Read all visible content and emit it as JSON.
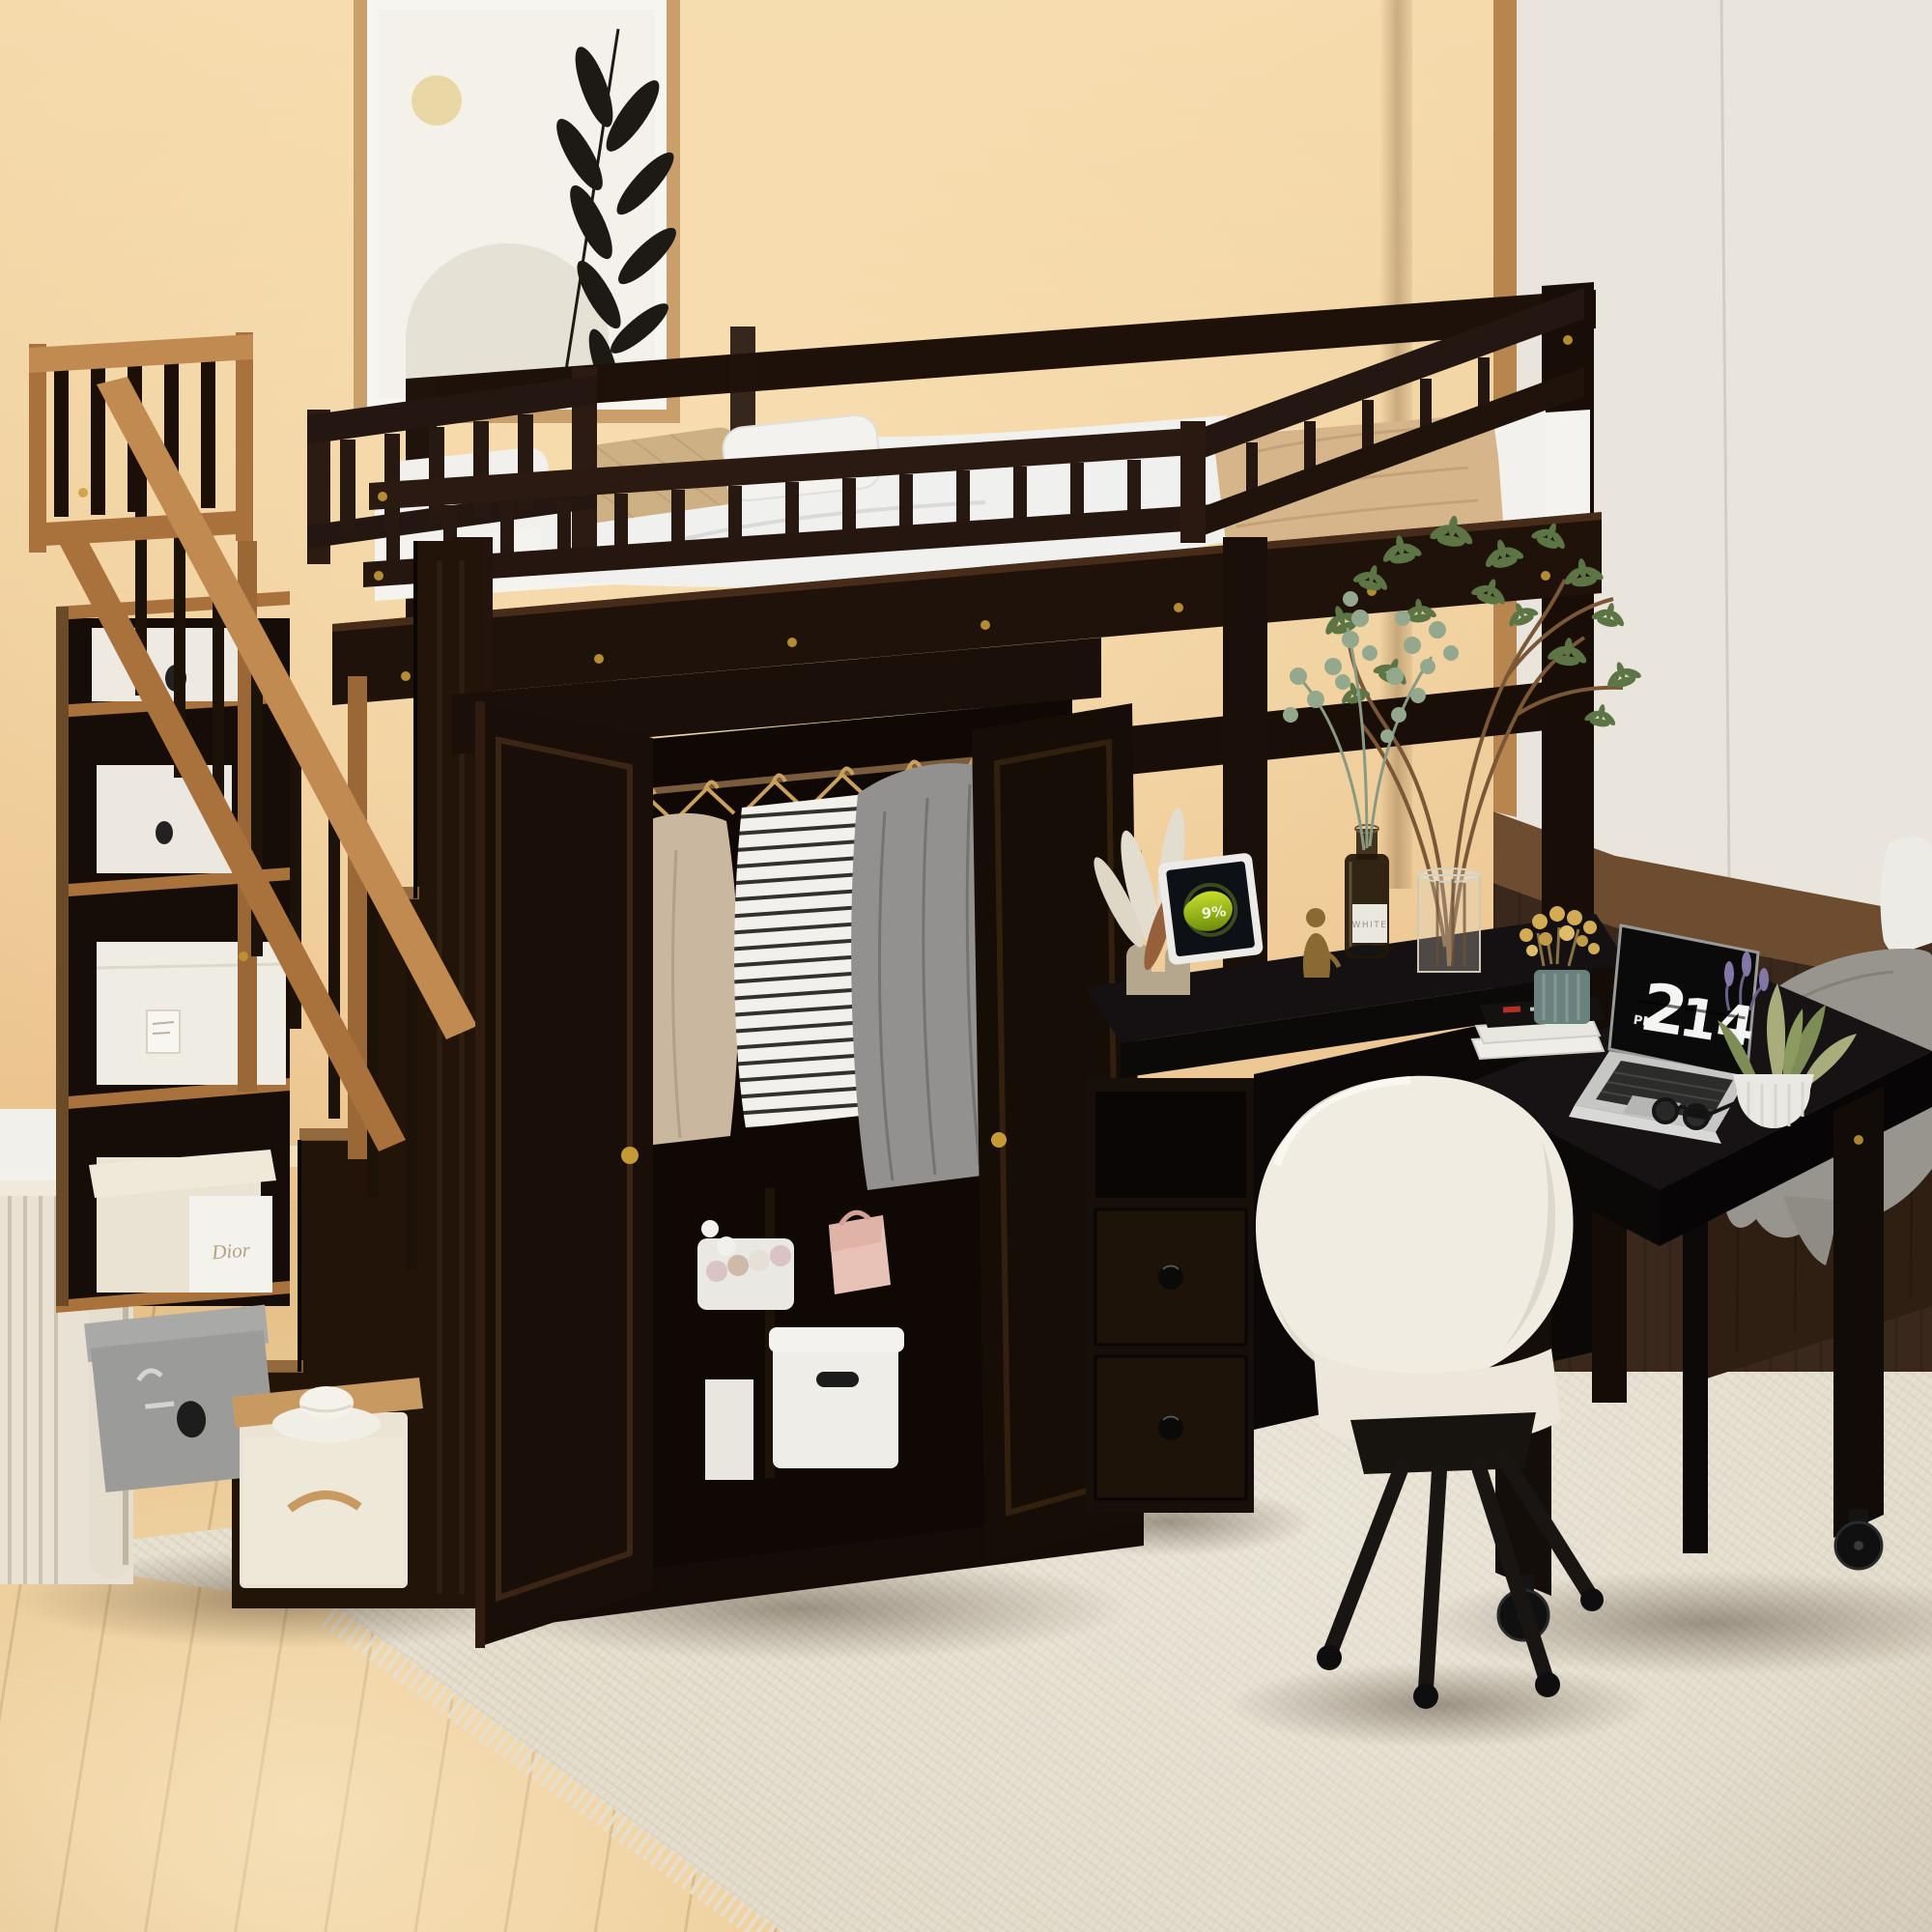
{
  "labels": {
    "wardrobe_box_brand": "Dior",
    "bottle_label": "WHITE",
    "tablet_battery": "9%"
  },
  "laptop_clock": {
    "meridiem": "PM",
    "hour": "2",
    "minute": "14"
  },
  "palette": {
    "wall": "#eac28c",
    "wall_light": "#f4d9aa",
    "baseboard": "#f1e3c2",
    "floor": "#e0ba81",
    "rug": "#ede7d9",
    "rug_shadow": "#dcd4c1",
    "rug_fringe": "#e6dfcd",
    "espresso": "#241610",
    "espresso_dark": "#150c07",
    "espresso_light": "#3a2416",
    "caramel": "#a9723c",
    "caramel_light": "#c08a50",
    "panel_white": "#e9e5dd",
    "panel_wood": "#b9854f",
    "paneling_dark": "#39281b",
    "bench_brown": "#2f1e12",
    "blanket_gray": "#98948e",
    "mattress": "#f5f3ef",
    "pillow_tan": "#cdb083",
    "blanket_tan": "#d6b58b",
    "chair_white": "#f0ece1",
    "chair_leg": "#191512",
    "laptop_silver": "#c6c6c4",
    "screen_black": "#0a0a0a",
    "clock_digits": "#f4f4f2",
    "tablet_green": "#a8c816",
    "gold": "#c59a36",
    "plant_green": "#5d7544",
    "eucalyptus": "#93a88d",
    "branch_brown": "#7a5736",
    "pampas": "#e3ddcf",
    "art_frame": "#c9a06b",
    "art_leaf": "#1d1a16",
    "cream_box": "#eae3d3",
    "gray_box": "#9b9b99",
    "white_bin": "#ebe4d4",
    "pink_bag": "#e8c2b6",
    "teal_pot": "#69827e",
    "dried_flower": "#d2ab54"
  }
}
